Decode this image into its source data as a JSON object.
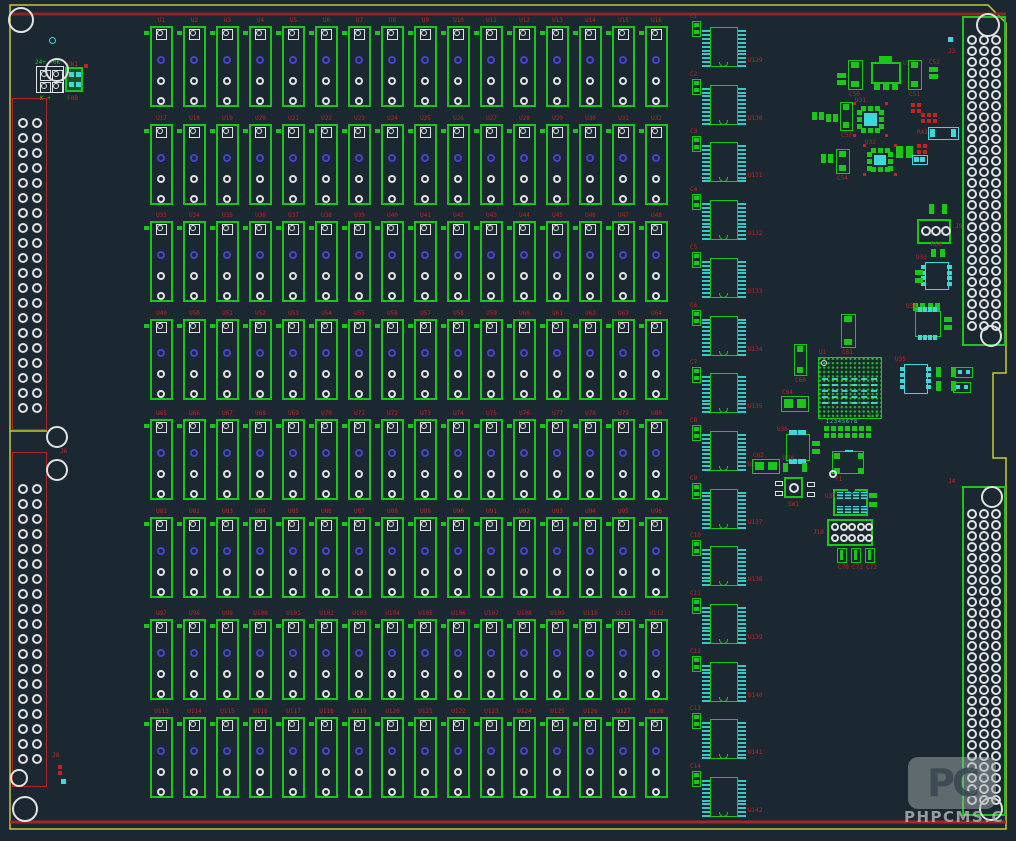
{
  "colors": {
    "background": "#1b2831",
    "green": "#19c619",
    "cyan": "#3bd9d9",
    "label_red": "#c32222",
    "outline_red": "#8e2424",
    "board_edge_yellow": "#c9c92f",
    "pad_blue": "#4444d0",
    "pad_white": "#e2e2e2"
  },
  "watermark": {
    "logo": "PC",
    "caption": "PHPCMS.C"
  },
  "power": {
    "label_top": "24+ -0K",
    "label_bottom": "K +",
    "module_label_top": "GN1",
    "module_label_bottom": "F0B"
  },
  "connectors": {
    "left_top": {
      "designator": "J6",
      "rows": 20
    },
    "left_bottom": {
      "designator": "J8",
      "rows": 19
    },
    "right_top": {
      "designator": "J3",
      "rows": 27
    },
    "right_bottom": {
      "designator": "J4",
      "rows": 27
    }
  },
  "relay_grid": {
    "columns": 16,
    "rows": 8,
    "designators": [
      "U1",
      "U2",
      "U3",
      "U4",
      "U5",
      "U6",
      "U7",
      "U8",
      "U9",
      "U10",
      "U11",
      "U12",
      "U13",
      "U14",
      "U15",
      "U16",
      "U17",
      "U18",
      "U19",
      "U20",
      "U21",
      "U22",
      "U23",
      "U24",
      "U25",
      "U26",
      "U27",
      "U28",
      "U29",
      "U30",
      "U31",
      "U32",
      "U33",
      "U34",
      "U35",
      "U36",
      "U37",
      "U38",
      "U39",
      "U40",
      "U41",
      "U42",
      "U43",
      "U44",
      "U45",
      "U46",
      "U47",
      "U48",
      "U49",
      "U50",
      "U51",
      "U52",
      "U53",
      "U54",
      "U55",
      "U56",
      "U57",
      "U58",
      "U59",
      "U60",
      "U61",
      "U62",
      "U63",
      "U64",
      "U65",
      "U66",
      "U67",
      "U68",
      "U69",
      "U70",
      "U71",
      "U72",
      "U73",
      "U74",
      "U75",
      "U76",
      "U77",
      "U78",
      "U79",
      "U80",
      "U81",
      "U82",
      "U83",
      "U84",
      "U85",
      "U86",
      "U87",
      "U88",
      "U89",
      "U90",
      "U91",
      "U92",
      "U93",
      "U94",
      "U95",
      "U96",
      "U97",
      "U98",
      "U99",
      "U100",
      "U101",
      "U102",
      "U103",
      "U104",
      "U105",
      "U106",
      "U107",
      "U108",
      "U109",
      "U110",
      "U111",
      "U112",
      "U113",
      "U114",
      "U115",
      "U116",
      "U117",
      "U118",
      "U119",
      "U120",
      "U121",
      "U122",
      "U123",
      "U124",
      "U125",
      "U126",
      "U127",
      "U128"
    ]
  },
  "ic_column": {
    "designators": [
      "U129",
      "U130",
      "U131",
      "U132",
      "U133",
      "U134",
      "U135",
      "U136",
      "U137",
      "U138",
      "U139",
      "U140",
      "U141",
      "U142"
    ],
    "cap_labels": [
      "C1",
      "C2",
      "C3",
      "C4",
      "C5",
      "C6",
      "C7",
      "C8",
      "C9",
      "C10",
      "C11",
      "C12",
      "C13",
      "C14"
    ]
  },
  "holes": [
    {
      "x": 21,
      "y": 20,
      "r": 13
    },
    {
      "x": 57,
      "y": 70,
      "r": 12
    },
    {
      "x": 57,
      "y": 437,
      "r": 11
    },
    {
      "x": 57,
      "y": 470,
      "r": 11
    },
    {
      "x": 19,
      "y": 778,
      "r": 9
    },
    {
      "x": 25,
      "y": 809,
      "r": 13
    },
    {
      "x": 988,
      "y": 25,
      "r": 12
    },
    {
      "x": 991,
      "y": 336,
      "r": 11
    },
    {
      "x": 992,
      "y": 497,
      "r": 11
    },
    {
      "x": 991,
      "y": 809,
      "r": 12
    }
  ],
  "cluster_parts": [
    {
      "t": "cap3v",
      "x": 848,
      "y": 60,
      "w": 15,
      "h": 30,
      "label": "C50"
    },
    {
      "t": "pads2v",
      "x": 837,
      "y": 73,
      "w": 9,
      "h": 12,
      "label": ""
    },
    {
      "t": "sot223",
      "x": 871,
      "y": 56,
      "w": 30,
      "h": 34,
      "label": "U30"
    },
    {
      "t": "cap3v",
      "x": 908,
      "y": 60,
      "w": 14,
      "h": 30,
      "label": "C51"
    },
    {
      "t": "pads2v",
      "x": 929,
      "y": 67,
      "w": 9,
      "h": 12,
      "label": "C52"
    },
    {
      "t": "redgrid",
      "x": 921,
      "y": 113,
      "cols": 3,
      "rows": 2
    },
    {
      "t": "qfn",
      "x": 857,
      "y": 106,
      "w": 27,
      "h": 27,
      "label": "U31"
    },
    {
      "t": "cap3v",
      "x": 840,
      "y": 102,
      "w": 13,
      "h": 29,
      "label": "C53"
    },
    {
      "t": "pads2h",
      "x": 812,
      "y": 112,
      "w": 12,
      "h": 8,
      "label": ""
    },
    {
      "t": "pads2h",
      "x": 826,
      "y": 114,
      "w": 12,
      "h": 8,
      "label": ""
    },
    {
      "t": "redgrid",
      "x": 911,
      "y": 103,
      "cols": 2,
      "rows": 2
    },
    {
      "t": "chiprc",
      "x": 928,
      "y": 127,
      "w": 31,
      "h": 13,
      "label": "R42"
    },
    {
      "t": "qfn",
      "x": 867,
      "y": 148,
      "w": 26,
      "h": 24,
      "label": "U32"
    },
    {
      "t": "cap3v",
      "x": 836,
      "y": 149,
      "w": 14,
      "h": 25,
      "label": "C54"
    },
    {
      "t": "pads2h",
      "x": 821,
      "y": 154,
      "w": 12,
      "h": 9,
      "label": ""
    },
    {
      "t": "cappair",
      "x": 896,
      "y": 146,
      "w": 17,
      "h": 12,
      "label": ""
    },
    {
      "t": "chiprc",
      "x": 912,
      "y": 155,
      "w": 16,
      "h": 10,
      "label": ""
    },
    {
      "t": "redgrid",
      "x": 917,
      "y": 144,
      "cols": 2,
      "rows": 2
    },
    {
      "t": "cyansq",
      "x": 948,
      "y": 37,
      "w": 5,
      "h": 5
    },
    {
      "t": "cyanring",
      "x": 49,
      "y": 37,
      "w": 7,
      "h": 7
    },
    {
      "t": "pads2h",
      "x": 929,
      "y": 204,
      "w": 18,
      "h": 10,
      "label": ""
    },
    {
      "t": "term3",
      "x": 917,
      "y": 219,
      "w": 34,
      "h": 25,
      "label": "J9"
    },
    {
      "t": "pads2h",
      "x": 931,
      "y": 249,
      "w": 14,
      "h": 8,
      "label": "R60"
    },
    {
      "t": "soic8",
      "x": 925,
      "y": 262,
      "w": 24,
      "h": 28,
      "o": "v",
      "cyanbody": true,
      "label": "U33"
    },
    {
      "t": "pads2v",
      "x": 915,
      "y": 270,
      "w": 8,
      "h": 13,
      "label": ""
    },
    {
      "t": "pads2h",
      "x": 913,
      "y": 303,
      "w": 12,
      "h": 8
    },
    {
      "t": "pads2h",
      "x": 928,
      "y": 303,
      "w": 12,
      "h": 8
    },
    {
      "t": "soic8",
      "x": 915,
      "y": 311,
      "w": 26,
      "h": 26,
      "o": "h",
      "label": "U34"
    },
    {
      "t": "pads2v",
      "x": 944,
      "y": 317,
      "w": 8,
      "h": 13
    },
    {
      "t": "cap3v",
      "x": 841,
      "y": 314,
      "w": 15,
      "h": 34,
      "label": "C61"
    },
    {
      "t": "cap3v",
      "x": 794,
      "y": 344,
      "w": 13,
      "h": 32,
      "label": "C60"
    },
    {
      "t": "bga",
      "x": 818,
      "y": 357,
      "w": 64,
      "h": 62,
      "label": "U1",
      "sub": "1.0"
    },
    {
      "t": "capbig",
      "x": 781,
      "y": 396,
      "w": 28,
      "h": 16,
      "label": "C64"
    },
    {
      "t": "soic8",
      "x": 904,
      "y": 364,
      "w": 24,
      "h": 30,
      "o": "v",
      "cyanbody": true,
      "label": "U35"
    },
    {
      "t": "pads2h",
      "x": 936,
      "y": 367,
      "w": 20,
      "h": 10
    },
    {
      "t": "pads2h",
      "x": 936,
      "y": 381,
      "w": 20,
      "h": 10
    },
    {
      "t": "pads2ho",
      "x": 955,
      "y": 367,
      "w": 18,
      "h": 11
    },
    {
      "t": "pads2ho",
      "x": 953,
      "y": 382,
      "w": 18,
      "h": 11
    },
    {
      "t": "padrow",
      "x": 824,
      "y": 426,
      "label": "12345678"
    },
    {
      "t": "soic8",
      "x": 786,
      "y": 434,
      "w": 24,
      "h": 27,
      "o": "h",
      "label": "U36"
    },
    {
      "t": "pads2v",
      "x": 812,
      "y": 441,
      "w": 8,
      "h": 13
    },
    {
      "t": "capbig",
      "x": 752,
      "y": 459,
      "w": 28,
      "h": 15,
      "label": "C62"
    },
    {
      "t": "pads2h",
      "x": 783,
      "y": 463,
      "w": 24,
      "h": 9,
      "label": "R50"
    },
    {
      "t": "corner4",
      "x": 832,
      "y": 451,
      "w": 32,
      "h": 23,
      "label": "Y1"
    },
    {
      "t": "trimmer",
      "x": 784,
      "y": 477,
      "w": 19,
      "h": 21,
      "label": "SW1"
    },
    {
      "t": "dip8",
      "x": 833,
      "y": 489,
      "w": 35,
      "h": 27,
      "label": "U37"
    },
    {
      "t": "pads2v",
      "x": 869,
      "y": 493,
      "w": 8,
      "h": 14
    },
    {
      "t": "header2x5",
      "x": 827,
      "y": 519,
      "w": 46,
      "h": 27,
      "label": "J10"
    },
    {
      "t": "cap2v",
      "x": 837,
      "y": 548,
      "w": 10,
      "h": 15,
      "label": "C70"
    },
    {
      "t": "cap2v",
      "x": 851,
      "y": 548,
      "w": 10,
      "h": 15,
      "label": "C71"
    },
    {
      "t": "cap2v",
      "x": 865,
      "y": 548,
      "w": 10,
      "h": 15,
      "label": "C72"
    },
    {
      "t": "redgrid",
      "x": 58,
      "y": 765,
      "cols": 1,
      "rows": 2
    },
    {
      "t": "cyansq",
      "x": 61,
      "y": 779,
      "w": 5,
      "h": 5
    }
  ]
}
